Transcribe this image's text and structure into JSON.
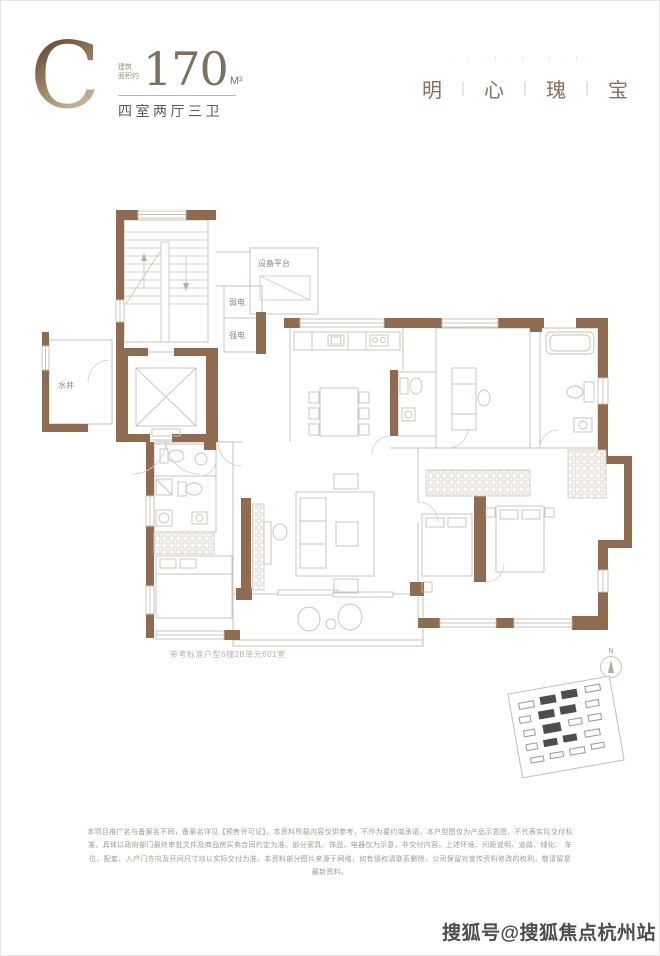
{
  "header": {
    "unit_letter": "C",
    "area_label_line1": "建筑",
    "area_label_line2": "面积约",
    "area_value": "170",
    "area_unit": "M²",
    "layout_desc": "四室两厅三卫",
    "tagline_marks": "· ı · ı · ı · ı · ı ·",
    "slogan_chars": [
      "明",
      "心",
      "瑰",
      "宝"
    ],
    "slogan_separator": "丨"
  },
  "floorplan": {
    "labels": {
      "equipment_platform": "设备平台",
      "weak_electric": "弱电",
      "strong_electric": "强电",
      "water_well": "水井"
    },
    "caption": "参考标准户型6幢2B单元601室",
    "compass_letter": "N",
    "colors": {
      "wall": "#8f6b52",
      "line": "#c9c1b6",
      "label": "#8f897d"
    }
  },
  "siteplan": {
    "blocks": [
      {
        "x": 8,
        "y": 10,
        "w": 16,
        "h": 7,
        "f": 0
      },
      {
        "x": 30,
        "y": 8,
        "w": 16,
        "h": 8,
        "f": 1
      },
      {
        "x": 52,
        "y": 6,
        "w": 16,
        "h": 8,
        "f": 1
      },
      {
        "x": 76,
        "y": 5,
        "w": 16,
        "h": 7,
        "f": 0
      },
      {
        "x": 6,
        "y": 24,
        "w": 12,
        "h": 7,
        "f": 0
      },
      {
        "x": 26,
        "y": 22,
        "w": 16,
        "h": 8,
        "f": 1
      },
      {
        "x": 48,
        "y": 21,
        "w": 16,
        "h": 8,
        "f": 1
      },
      {
        "x": 74,
        "y": 20,
        "w": 14,
        "h": 7,
        "f": 0
      },
      {
        "x": 8,
        "y": 38,
        "w": 12,
        "h": 7,
        "f": 0
      },
      {
        "x": 28,
        "y": 36,
        "w": 18,
        "h": 9,
        "f": 1
      },
      {
        "x": 54,
        "y": 35,
        "w": 14,
        "h": 7,
        "f": 0
      },
      {
        "x": 74,
        "y": 34,
        "w": 14,
        "h": 7,
        "f": 0
      },
      {
        "x": 8,
        "y": 52,
        "w": 12,
        "h": 7,
        "f": 0
      },
      {
        "x": 26,
        "y": 51,
        "w": 14,
        "h": 7,
        "f": 1
      },
      {
        "x": 46,
        "y": 50,
        "w": 14,
        "h": 7,
        "f": 1
      },
      {
        "x": 68,
        "y": 49,
        "w": 16,
        "h": 7,
        "f": 0
      },
      {
        "x": 10,
        "y": 66,
        "w": 14,
        "h": 6,
        "f": 0
      },
      {
        "x": 30,
        "y": 65,
        "w": 14,
        "h": 6,
        "f": 0
      },
      {
        "x": 50,
        "y": 64,
        "w": 16,
        "h": 7,
        "f": 0
      },
      {
        "x": 72,
        "y": 63,
        "w": 14,
        "h": 6,
        "f": 0
      }
    ]
  },
  "disclaimer": {
    "line1": "本项目推广名与备案名不同，备案名详见【预售许可证】。本资料所载内容仅供参考，不作为要约或承诺，本户型图仅为产品示意图，不代表实际交付标准，具体以政府部门最终审批文件及商品房买卖合同约定为准。部分家具、饰品、电器仅为示意，非交付内容。上述环境、间距说明、道路、绿化、",
    "line2": "车位、配套、入户门方向及开间尺寸均以实际交付为准。本资料部分图片来源于网络，如有侵权请联系删除，公司保留对宣传资料修改的权利，敬请留意最新资料。"
  },
  "watermark": {
    "text": "搜狐号@搜狐焦点杭州站"
  }
}
